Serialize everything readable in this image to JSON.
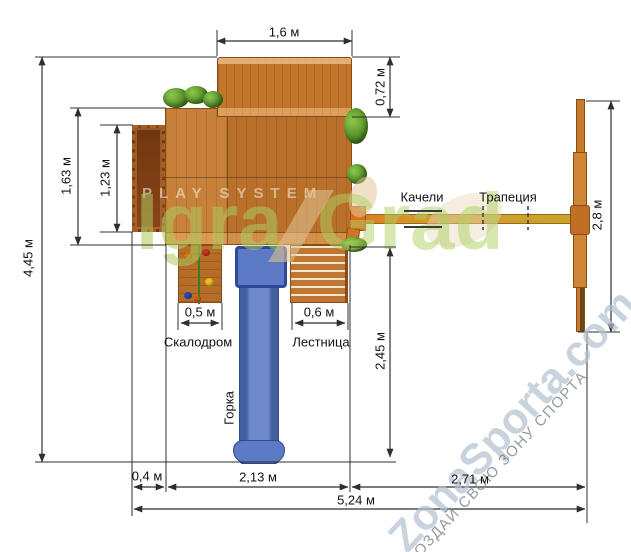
{
  "dims": {
    "top_width": "1,6 м",
    "roof_depth": "0,72 м",
    "left_depth": "1,63 м",
    "balcony_span": "1,23 м",
    "total_depth": "4,45 м",
    "swing_frame_width": "2,8 м",
    "climb_width": "0,5 м",
    "ladder_width": "0,6 м",
    "slide_length": "2,45 м",
    "balcony_depth": "0,4 м",
    "platform_span": "2,13 м",
    "swing_span": "2,71 м",
    "total_width": "5,24 м"
  },
  "labels": {
    "swing": "Качели",
    "trapeze": "Трапеция",
    "climbing_wall": "Скалодром",
    "ladder": "Лестница",
    "slide": "Горка"
  },
  "watermarks": {
    "playsystem": "PLAY SYSTEM",
    "brand_left": "Igra",
    "brand_right": "Grad",
    "site": "ZonaSporta.com",
    "slogan": "СОЗДАЙ СВОЮ ЗОНУ СПОРТА"
  },
  "colors": {
    "wood": "#c0782f",
    "wood_dark": "#8a4c17",
    "beam_orange": "#dd7a20",
    "beam_olive": "#c9a32c",
    "slide_blue": "#5d7ac6",
    "slide_blue_dark": "#31498f",
    "dim_line": "#2f2f2f",
    "brand_green": "#aecb63",
    "site_blue": "#b0c0ce",
    "slogan_gray": "#84888e",
    "bush_green": "#4e8f23"
  }
}
